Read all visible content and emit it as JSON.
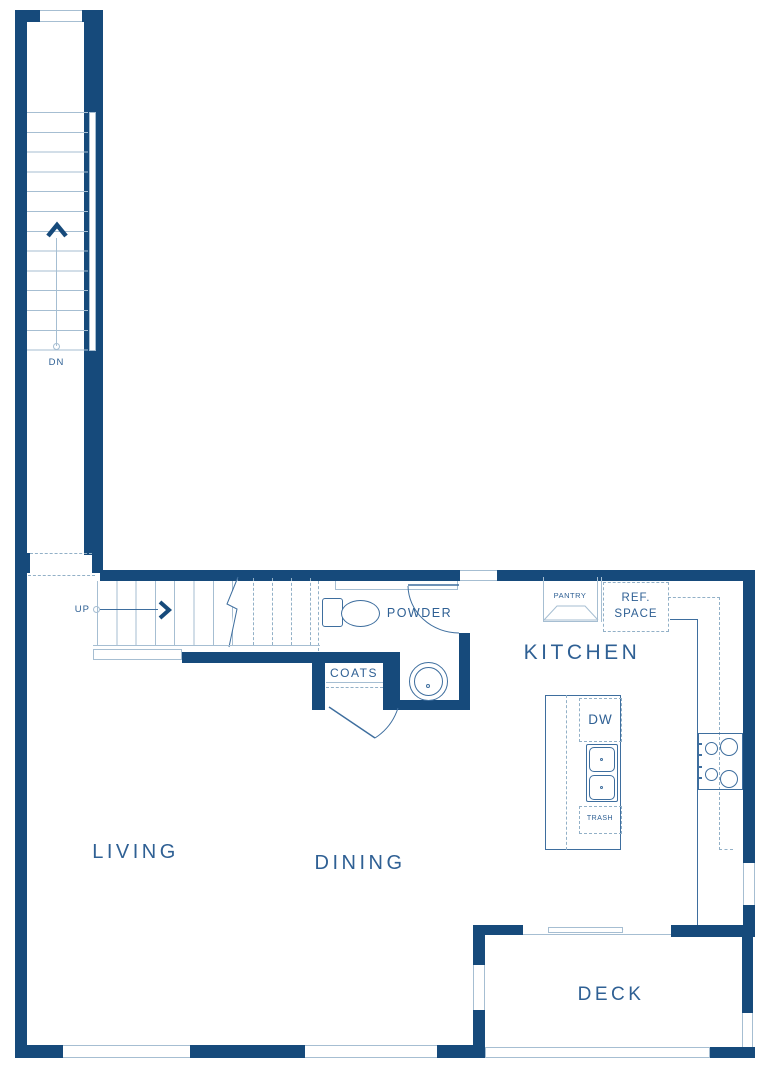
{
  "colors": {
    "wall": "#164A7B",
    "line": "#3E6E9E",
    "light_line": "#A6BED2",
    "dash": "#92B0C7",
    "text": "#2F6094",
    "background": "#ffffff"
  },
  "rooms": {
    "living": {
      "label": "LIVING"
    },
    "dining": {
      "label": "DINING"
    },
    "kitchen": {
      "label": "KITCHEN"
    },
    "powder": {
      "label": "POWDER"
    },
    "coats": {
      "label": "COATS"
    },
    "deck": {
      "label": "DECK"
    }
  },
  "kitchen_features": {
    "pantry": {
      "label": "PANTRY"
    },
    "ref_space": {
      "line1": "REF.",
      "line2": "SPACE"
    },
    "dishwasher": {
      "label": "DW"
    },
    "trash": {
      "label": "TRASH"
    }
  },
  "stairs": {
    "up": {
      "label": "UP"
    },
    "down": {
      "label": "DN"
    }
  }
}
